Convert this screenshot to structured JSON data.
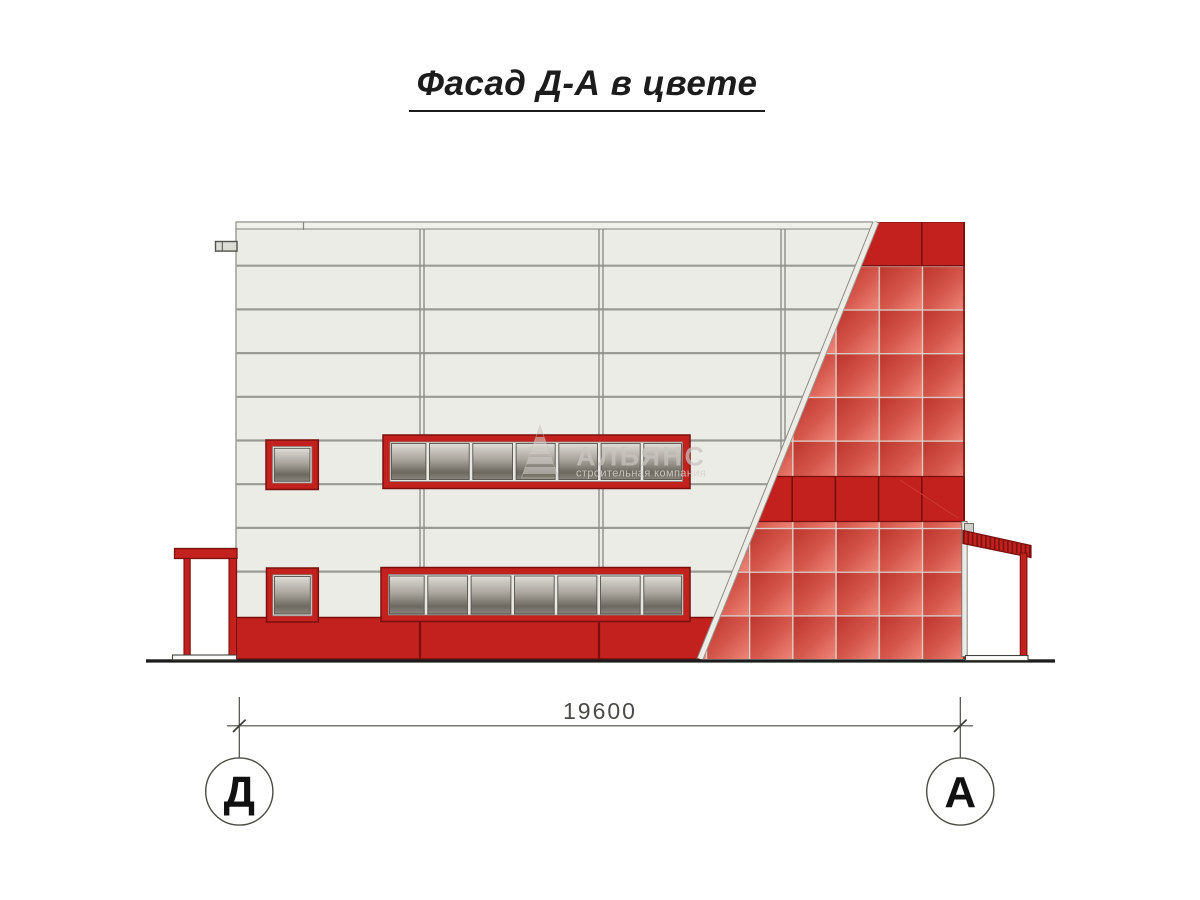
{
  "title": {
    "text": "Фасад Д-А в цвете"
  },
  "dimension": {
    "value": "19600"
  },
  "axis_markers": {
    "left": "Д",
    "right": "А"
  },
  "watermark": {
    "company": "АЛЬЯНС",
    "tagline": "строительная компания",
    "logo": "pyramid-logo"
  },
  "facade": {
    "white_panel_rows": 10,
    "vertical_joints": 3,
    "window_bands": 2,
    "window_band_panes": 7,
    "small_windows": 2,
    "red_accent_bands": 2
  },
  "colors": {
    "accent_red": "#c2211e",
    "red_outline": "#7a100e",
    "panel_red_from": "#bb342b",
    "panel_red_mid": "#d5564b",
    "panel_red_to": "#ee8678",
    "facade_white": "#ecece7",
    "joint_grey": "#8f8f89",
    "glass_top": "#e2e0db",
    "glass_bottom": "#6e6960",
    "ground": "#1c1c1c",
    "dimension_grey": "#4b4b46"
  }
}
